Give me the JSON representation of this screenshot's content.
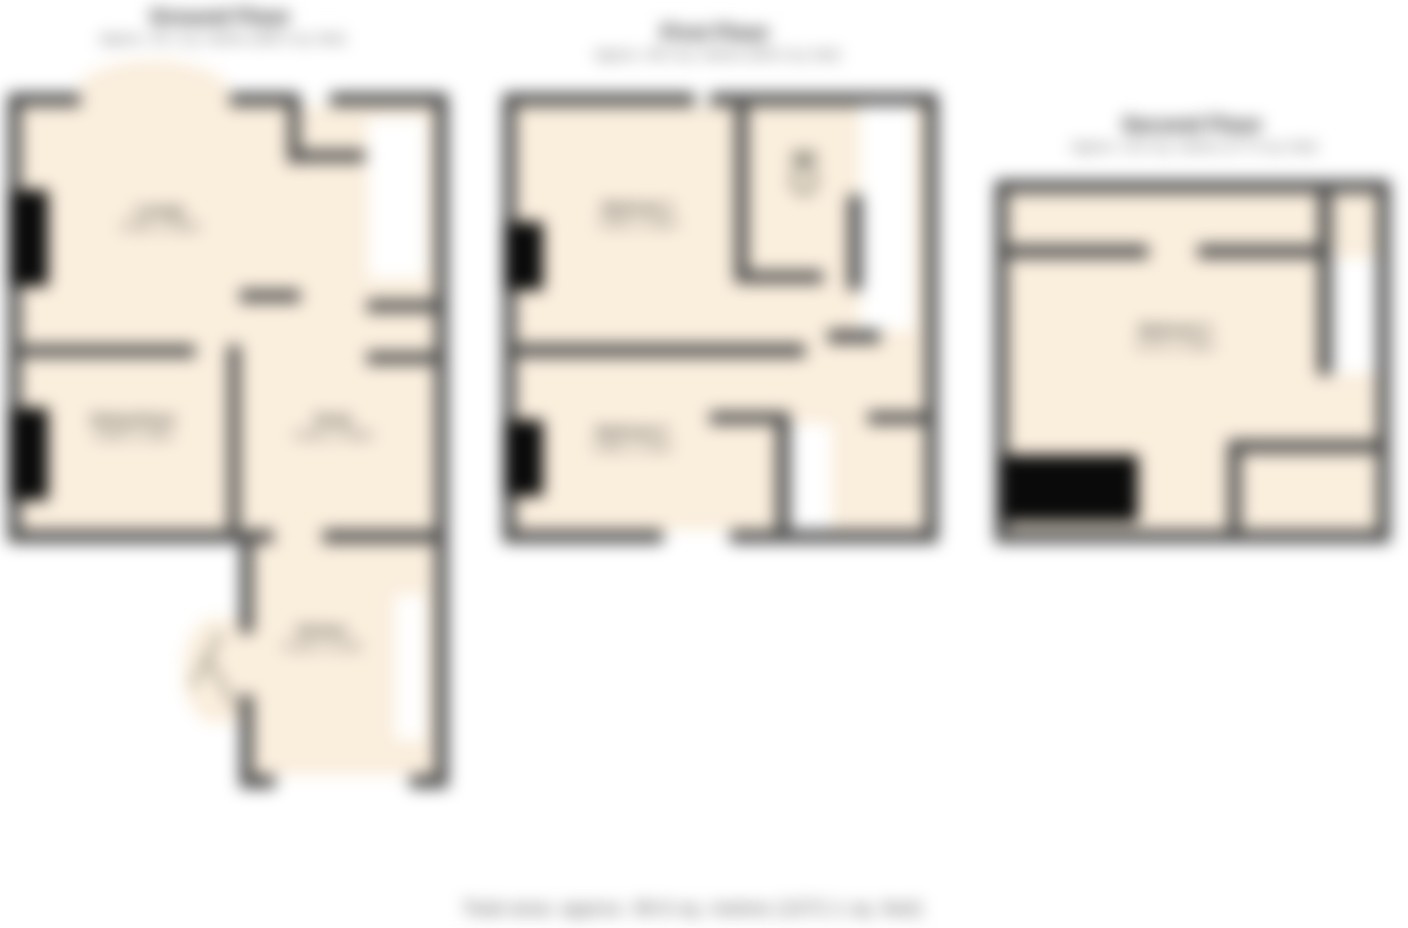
{
  "plans": [
    {
      "title": "Ground Floor",
      "subtitle": "Approx. 45.1 sq. metres (485.5 sq. feet)",
      "rooms": [
        {
          "name": "Lounge",
          "dims": "4.93m x 3.66m"
        },
        {
          "name": "Dining Room",
          "dims": "3.58m x 3.28m"
        },
        {
          "name": "Study",
          "dims": "2.84m x 2.69m"
        },
        {
          "name": "Kitchen",
          "dims": "3.33m x 2.24m"
        }
      ]
    },
    {
      "title": "First Floor",
      "subtitle": "Approx. 38.0 sq. metres (409.0 sq. feet)",
      "rooms": [
        {
          "name": "Bedroom 1",
          "dims": "4.95m x 3.66m"
        },
        {
          "name": "Bedroom 2",
          "dims": "3.58m x 3.30m"
        }
      ]
    },
    {
      "title": "Second Floor",
      "subtitle": "Approx. 16.5 sq. metres (177.6 sq. feet)",
      "rooms": [
        {
          "name": "Bedroom 3",
          "dims": "4.57m x 3.89m"
        }
      ]
    }
  ],
  "footer": {
    "text": "Total area: approx. 99.6 sq. metres (1072.1 sq. feet)"
  },
  "colors": {
    "floor_fill": "#faeedd",
    "wall": "#4c4c4c",
    "window_block": "#0a0a0a",
    "background": "#ffffff"
  }
}
